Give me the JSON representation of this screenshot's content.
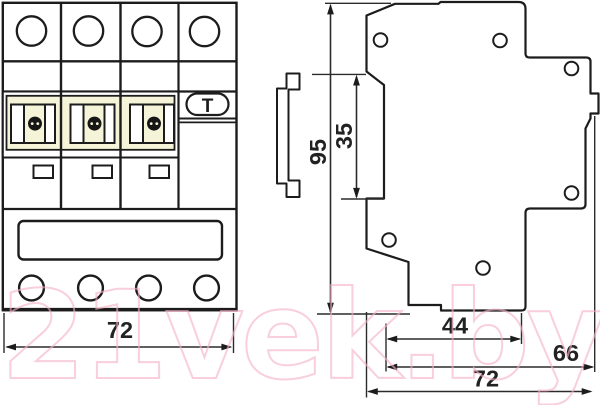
{
  "front_view": {
    "width_dimension": "72",
    "test_button_label": "T"
  },
  "side_view": {
    "height_dimension": "95",
    "din_rail_dimension": "35",
    "base_width_dimension": "44",
    "body_width_dimension": "66",
    "total_width_dimension": "72"
  },
  "watermark": {
    "text": "21vek.by",
    "color": "#f4b2c4"
  },
  "colors": {
    "outline": "#1c1c1c",
    "dimension_line": "#2b2b2b",
    "toggle_panel_beige": "#f5f3d8",
    "watermark_pink": "#f4b2c4",
    "background": "#ffffff"
  }
}
